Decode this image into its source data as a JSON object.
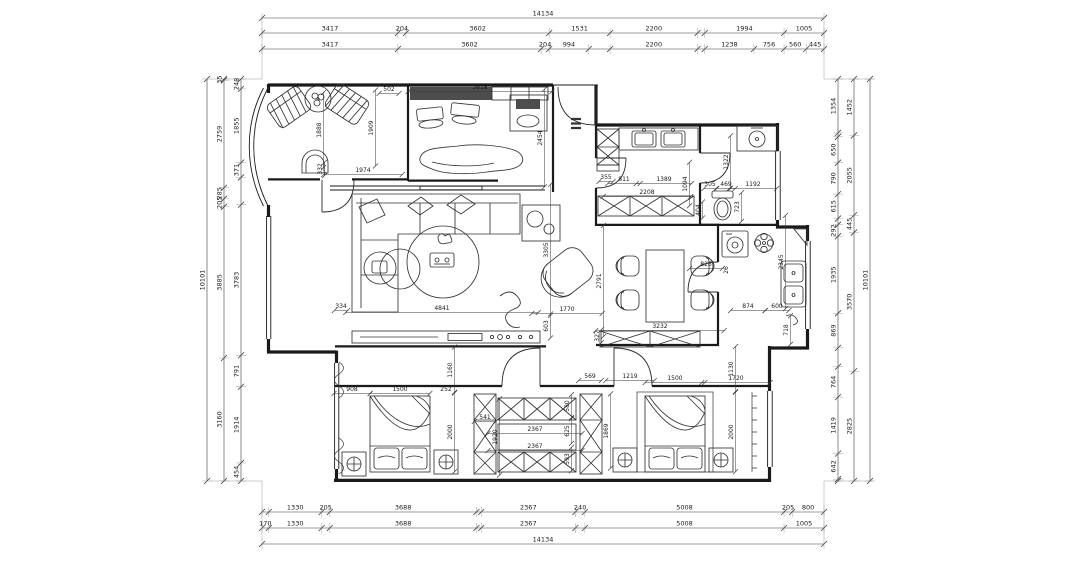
{
  "drawing": {
    "kind": "residential floor plan",
    "line_color": "#1a1a1a",
    "background": "#ffffff"
  },
  "dims": {
    "top": {
      "total": [
        {
          "t": "14134",
          "mm": 14134
        }
      ],
      "row1": [
        {
          "t": "3417",
          "mm": 3417
        },
        {
          "t": "204",
          "mm": 204
        },
        {
          "t": "3602",
          "mm": 3602
        },
        {
          "t": "1531",
          "mm": 1531
        },
        {
          "t": "2200",
          "mm": 2200
        },
        {
          "mm": 181
        },
        {
          "t": "1994",
          "mm": 1994
        },
        {
          "t": "1005",
          "mm": 1005
        }
      ],
      "row2": [
        {
          "t": "3417",
          "mm": 3417
        },
        {
          "t": "3602",
          "mm": 3602
        },
        {
          "t": "204",
          "mm": 204
        },
        {
          "t": "994",
          "mm": 994
        },
        {
          "mm": 537
        },
        {
          "t": "2200",
          "mm": 2200
        },
        {
          "mm": 181
        },
        {
          "t": "1238",
          "mm": 1238
        },
        {
          "t": "756",
          "mm": 756
        },
        {
          "t": "560",
          "mm": 560
        },
        {
          "t": "445",
          "mm": 445
        }
      ]
    },
    "bottom": {
      "row1": [
        {
          "mm": 170
        },
        {
          "t": "1330",
          "mm": 1330
        },
        {
          "t": "205",
          "mm": 205
        },
        {
          "t": "3688",
          "mm": 3688
        },
        {
          "mm": 121
        },
        {
          "t": "2367",
          "mm": 2367
        },
        {
          "t": "240",
          "mm": 240
        },
        {
          "t": "5008",
          "mm": 5008
        },
        {
          "t": "205",
          "mm": 205
        },
        {
          "t": "800",
          "mm": 800
        }
      ],
      "row2": [
        {
          "t": "170",
          "mm": 170
        },
        {
          "t": "1330",
          "mm": 1330
        },
        {
          "mm": 205
        },
        {
          "t": "3688",
          "mm": 3688
        },
        {
          "mm": 121
        },
        {
          "t": "2367",
          "mm": 2367
        },
        {
          "mm": 240
        },
        {
          "t": "5008",
          "mm": 5008
        },
        {
          "t": "1005",
          "mm": 1005
        }
      ],
      "total": [
        {
          "t": "14134",
          "mm": 14134
        }
      ]
    },
    "left": {
      "outer": [
        {
          "t": "10101",
          "mm": 10101
        }
      ],
      "middle": [
        {
          "t": "35",
          "mm": 35
        },
        {
          "t": "2759",
          "mm": 2759
        },
        {
          "t": "285",
          "mm": 285
        },
        {
          "t": "205",
          "mm": 205
        },
        {
          "t": "3885",
          "mm": 3885
        },
        {
          "t": "3160",
          "mm": 3160
        }
      ],
      "inner": [
        {
          "t": "248",
          "mm": 248
        },
        {
          "t": "1855",
          "mm": 1855
        },
        {
          "t": "371",
          "mm": 371
        },
        {
          "mm": 685
        },
        {
          "t": "3783",
          "mm": 3783
        },
        {
          "t": "791",
          "mm": 791
        },
        {
          "t": "1914",
          "mm": 1914
        },
        {
          "t": "454",
          "mm": 454
        }
      ]
    },
    "right": {
      "inner": [
        {
          "t": "1354",
          "mm": 1354
        },
        {
          "mm": 98
        },
        {
          "t": "650",
          "mm": 650
        },
        {
          "t": "790",
          "mm": 790
        },
        {
          "t": "615",
          "mm": 615
        },
        {
          "mm": 153
        },
        {
          "t": "292",
          "mm": 292
        },
        {
          "t": "1935",
          "mm": 1935
        },
        {
          "t": "869",
          "mm": 869
        },
        {
          "mm": 474
        },
        {
          "t": "764",
          "mm": 764
        },
        {
          "t": "1419",
          "mm": 1419
        },
        {
          "t": "642",
          "mm": 642
        },
        {
          "mm": 46
        }
      ],
      "middle": [
        {
          "t": "1452",
          "mm": 1452
        },
        {
          "t": "2055",
          "mm": 2055
        },
        {
          "t": "445",
          "mm": 445
        },
        {
          "t": "3570",
          "mm": 3570
        },
        {
          "t": "2825",
          "mm": 2825
        }
      ],
      "outer": [
        {
          "t": "10101",
          "mm": 10101
        }
      ]
    },
    "interior": [
      {
        "t": "502",
        "x": 389,
        "y": 91
      },
      {
        "t": "1888",
        "x": 321,
        "y": 130,
        "v": 1
      },
      {
        "t": "1909",
        "x": 373,
        "y": 128,
        "v": 1
      },
      {
        "t": "332",
        "x": 322,
        "y": 169,
        "v": 1
      },
      {
        "t": "1974",
        "x": 363,
        "y": 172
      },
      {
        "t": "3618",
        "x": 480,
        "y": 89
      },
      {
        "t": "2454",
        "x": 542,
        "y": 138,
        "v": 1
      },
      {
        "t": "355",
        "x": 606,
        "y": 179
      },
      {
        "t": "811",
        "x": 624,
        "y": 181
      },
      {
        "t": "1389",
        "x": 664,
        "y": 181
      },
      {
        "t": "1094",
        "x": 687,
        "y": 184,
        "v": 1
      },
      {
        "t": "2208",
        "x": 647,
        "y": 194
      },
      {
        "t": "404",
        "x": 700,
        "y": 210,
        "v": 1
      },
      {
        "t": "1322",
        "x": 728,
        "y": 162,
        "v": 1
      },
      {
        "t": "305",
        "x": 710,
        "y": 186
      },
      {
        "t": "469",
        "x": 726,
        "y": 186
      },
      {
        "t": "1192",
        "x": 753,
        "y": 186
      },
      {
        "t": "723",
        "x": 739,
        "y": 207,
        "v": 1
      },
      {
        "t": "334",
        "x": 341,
        "y": 308
      },
      {
        "t": "4841",
        "x": 442,
        "y": 310
      },
      {
        "t": "3305",
        "x": 548,
        "y": 250,
        "v": 1
      },
      {
        "t": "603",
        "x": 548,
        "y": 326,
        "v": 1
      },
      {
        "t": "1770",
        "x": 567,
        "y": 311
      },
      {
        "t": "327",
        "x": 599,
        "y": 336,
        "v": 1
      },
      {
        "t": "2791",
        "x": 601,
        "y": 281,
        "v": 1
      },
      {
        "t": "3232",
        "x": 660,
        "y": 328
      },
      {
        "t": "826",
        "x": 706,
        "y": 266
      },
      {
        "t": "26",
        "x": 728,
        "y": 270,
        "v": 1
      },
      {
        "t": "2345",
        "x": 783,
        "y": 262,
        "v": 1
      },
      {
        "t": "874",
        "x": 748,
        "y": 308
      },
      {
        "t": "600",
        "x": 777,
        "y": 308
      },
      {
        "t": "718",
        "x": 788,
        "y": 330,
        "v": 1
      },
      {
        "t": "908",
        "x": 352,
        "y": 391
      },
      {
        "t": "1500",
        "x": 400,
        "y": 391
      },
      {
        "t": "252",
        "x": 446,
        "y": 391
      },
      {
        "t": "1160",
        "x": 452,
        "y": 370,
        "v": 1
      },
      {
        "t": "2000",
        "x": 452,
        "y": 432,
        "v": 1
      },
      {
        "t": "541",
        "x": 485,
        "y": 419
      },
      {
        "t": "1920",
        "x": 497,
        "y": 437,
        "v": 1
      },
      {
        "t": "2367",
        "x": 535,
        "y": 431
      },
      {
        "t": "2367",
        "x": 535,
        "y": 448
      },
      {
        "t": "569",
        "x": 590,
        "y": 378
      },
      {
        "t": "580",
        "x": 569,
        "y": 406,
        "v": 1
      },
      {
        "t": "625",
        "x": 569,
        "y": 431,
        "v": 1
      },
      {
        "t": "593",
        "x": 569,
        "y": 459,
        "v": 1
      },
      {
        "t": "1869",
        "x": 608,
        "y": 431,
        "v": 1
      },
      {
        "t": "1219",
        "x": 630,
        "y": 378
      },
      {
        "t": "1500",
        "x": 675,
        "y": 380
      },
      {
        "t": "1720",
        "x": 736,
        "y": 380
      },
      {
        "t": "1130",
        "x": 733,
        "y": 369,
        "v": 1
      },
      {
        "t": "2000",
        "x": 733,
        "y": 432,
        "v": 1
      }
    ]
  }
}
